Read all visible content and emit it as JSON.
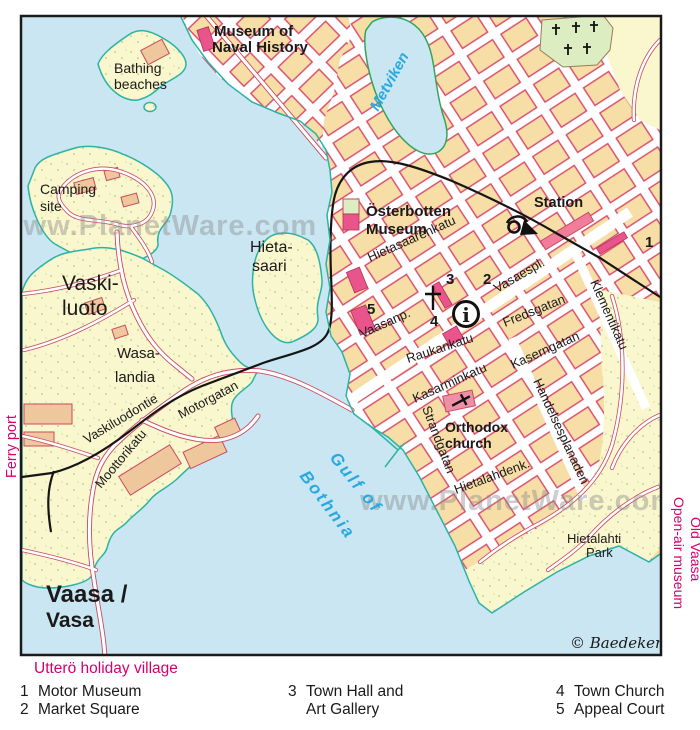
{
  "place_labels": {
    "museum_naval_1": "Museum of",
    "museum_naval_2": "Naval History",
    "bathing_1": "Bathing",
    "bathing_2": "beaches",
    "camping_1": "Camping",
    "camping_2": "site",
    "vaskiluoto_1": "Vaski-",
    "vaskiluoto_2": "luoto",
    "wasalandia_1": "Wasa-",
    "wasalandia_2": "landia",
    "hietasaari_1": "Hieta-",
    "hietasaari_2": "saari",
    "osterbotten_1": "Österbotten",
    "osterbotten_2": "Museum",
    "station": "Station",
    "orthodox_1": "Orthodox",
    "orthodox_2": "church",
    "hietalahti_1": "Hietalahti",
    "hietalahti_2": "Park",
    "metviken": "Metviken",
    "gulf_1": "Gulf of",
    "gulf_2": "Bothnia"
  },
  "street_labels": {
    "hietasaarenkatu": "Hietasaarenkatu",
    "vaasanp": "Vaasanp.",
    "vasaespl": "Vasaespl.",
    "fredsgatan": "Fredsgatan",
    "raukankatu": "Raukankatu",
    "kasarminkatu": "Kasarminkatu",
    "kaserngatan": "Kaserngatan",
    "strandgatan": "Strandgatan",
    "handelsesplanaden": "Handelsesplanaden",
    "klementikatu": "Klementikatu",
    "hietalahdenk": "Hietalahdenk.",
    "vaskiluodontie": "Vaskiluodontie",
    "moottorikatu": "Moottorikatu",
    "motorgatan": "Motorgatan"
  },
  "markers": {
    "m1": "1",
    "m2": "2",
    "m3": "3",
    "m4": "4",
    "m5": "5"
  },
  "title": {
    "line1": "Vaasa /",
    "line2": "Vasa"
  },
  "edge_labels": {
    "ferry_port": "Ferry port",
    "old_vaasa_1": "Old Vaasa",
    "old_vaasa_2": "Open-air museum",
    "uttero": "Utterö holiday village"
  },
  "watermark": "www.PlanetWare.com",
  "copyright": "© Baedeker",
  "info_symbol": "i",
  "legend": {
    "items": [
      {
        "num": "1",
        "label": "Motor Museum"
      },
      {
        "num": "2",
        "label": "Market Square"
      },
      {
        "num": "3",
        "label": "Town Hall and",
        "label2": "Art Gallery"
      },
      {
        "num": "4",
        "label": "Town Church"
      },
      {
        "num": "5",
        "label": "Appeal Court"
      }
    ]
  },
  "colors": {
    "water": "#C9E6F2",
    "land": "#FAF6CD",
    "block_fill": "#F6DEA6",
    "block_stroke": "#D8476B",
    "building_pink": "#E9548C",
    "station_pink": "#F27D9B",
    "industrial_orange": "#EFC79C",
    "cemetery_green": "#DCEDC2",
    "coastline_teal": "#2BB3A3",
    "lake_outline_green": "#33A55A",
    "magenta_text": "#D4006E",
    "water_text_blue": "#2AA9DE",
    "railway_black": "#151515",
    "watermark_gray": "#8a8a8a"
  }
}
